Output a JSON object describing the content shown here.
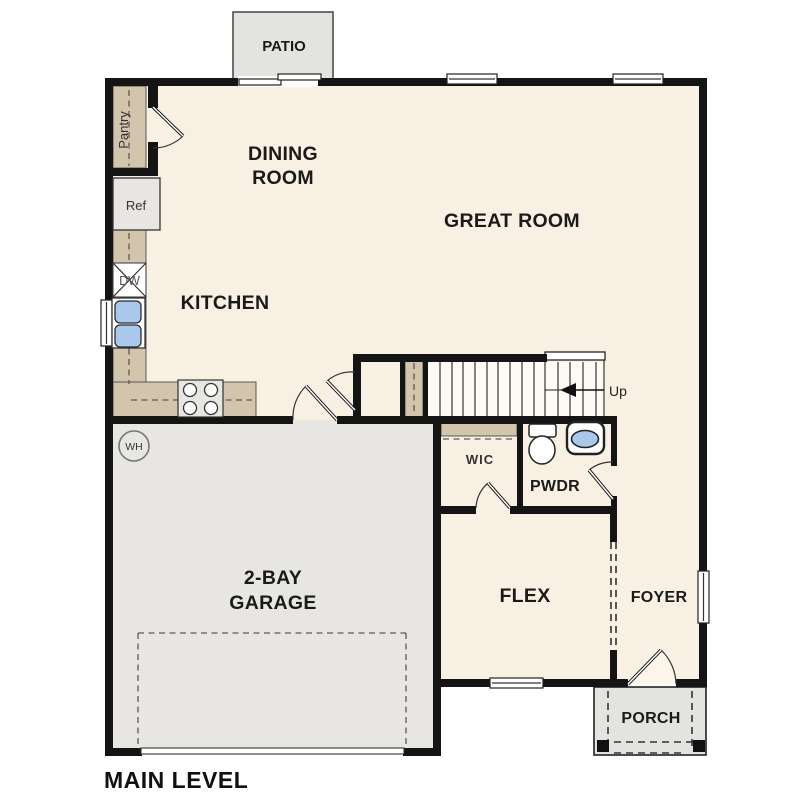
{
  "plan": {
    "title": "MAIN LEVEL",
    "rooms": {
      "dining": {
        "line1": "DINING",
        "line2": "ROOM"
      },
      "great_room": {
        "label": "GREAT ROOM"
      },
      "kitchen": {
        "label": "KITCHEN"
      },
      "garage": {
        "line1": "2-BAY",
        "line2": "GARAGE"
      },
      "flex": {
        "label": "FLEX"
      },
      "foyer": {
        "label": "FOYER"
      },
      "wic": {
        "label": "WIC"
      },
      "powder": {
        "label": "PWDR"
      },
      "patio": {
        "label": "PATIO"
      },
      "porch": {
        "label": "PORCH"
      }
    },
    "fixtures": {
      "pantry": "Pantry",
      "refrigerator": "Ref",
      "dishwasher": "DW",
      "water_heater": "WH",
      "stair_direction": "Up"
    },
    "colors": {
      "floor": "#f8f0e2",
      "garage_floor": "#e7e6e2",
      "outdoor": "#e3e3e0",
      "counter": "#d2c5ac",
      "wall": "#141414",
      "sink": "#a9c9ec"
    }
  }
}
